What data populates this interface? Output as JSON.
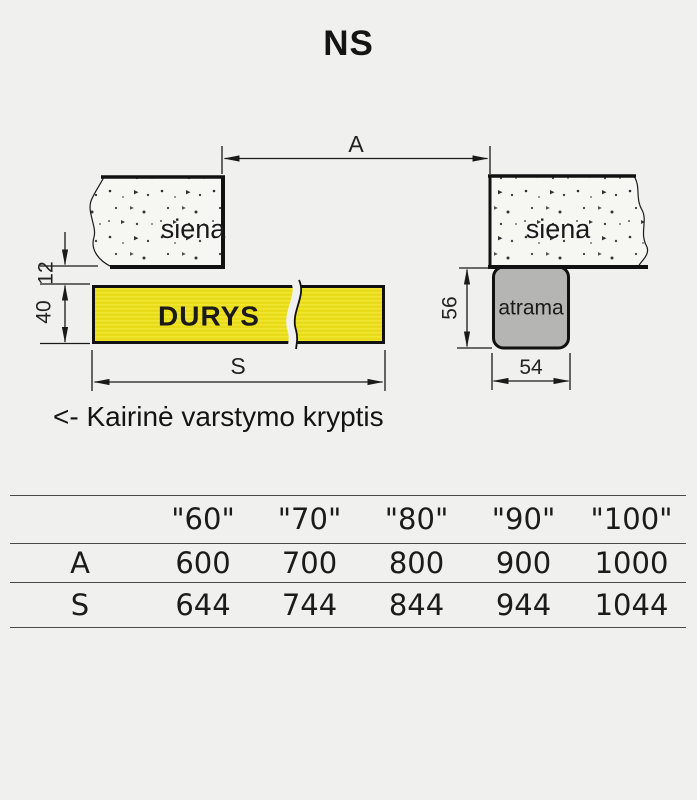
{
  "title": "NS",
  "diagram": {
    "wall_left_label": "siena",
    "wall_right_label": "siena",
    "door_label": "DURYS",
    "support_label": "atrama",
    "dim_opening": "A",
    "dim_door_width": "S",
    "dim_gap": "12",
    "dim_door_thickness": "40",
    "dim_support_height": "56",
    "dim_support_width": "54",
    "direction_note": "<- Kairinė varstymo kryptis"
  },
  "colors": {
    "background": "#f0f0ee",
    "door_fill": "#ebdf1d",
    "support_fill": "#b5b5b4",
    "line": "#1a1a1a"
  },
  "table": {
    "header": [
      "",
      "\"60\"",
      "\"70\"",
      "\"80\"",
      "\"90\"",
      "\"100\""
    ],
    "rows": [
      {
        "label": "A",
        "values": [
          "600",
          "700",
          "800",
          "900",
          "1000"
        ]
      },
      {
        "label": "S",
        "values": [
          "644",
          "744",
          "844",
          "944",
          "1044"
        ]
      }
    ]
  }
}
